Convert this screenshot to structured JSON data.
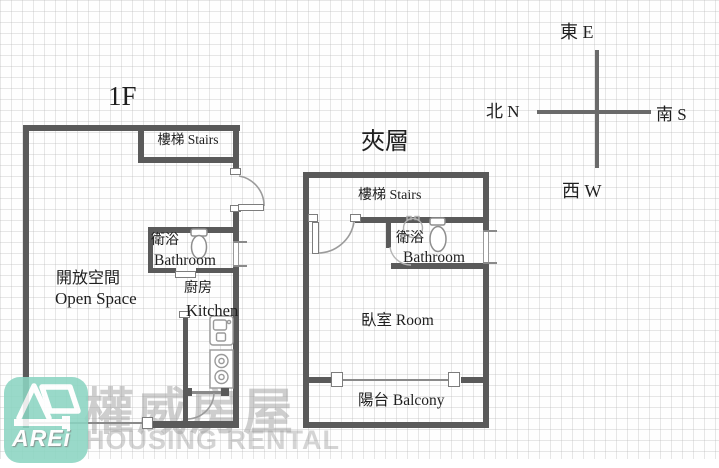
{
  "compass": {
    "east": "東 E",
    "south": "南 S",
    "west": "西 W",
    "north": "北 N"
  },
  "floor1": {
    "title": "1F",
    "stairs": "樓梯 Stairs",
    "bathroom_zh": "衛浴",
    "bathroom_en": "Bathroom",
    "open_space_zh": "開放空間",
    "open_space_en": "Open Space",
    "kitchen_zh": "廚房",
    "kitchen_en": "Kitchen"
  },
  "mezzanine": {
    "title": "夾層",
    "stairs": "樓梯 Stairs",
    "bathroom_zh": "衛浴",
    "bathroom_en": "Bathroom",
    "bedroom": "臥室 Room",
    "balcony": "陽台 Balcony"
  },
  "watermark": {
    "brand_zh": "權威房屋",
    "brand_en": "HOUSING RENTAL",
    "logo_text": "AREi"
  },
  "colors": {
    "wall": "#5a5a5a",
    "logo_mint": "#8cd5c2",
    "watermark_gray": "#969696",
    "line_gray": "#999999"
  }
}
